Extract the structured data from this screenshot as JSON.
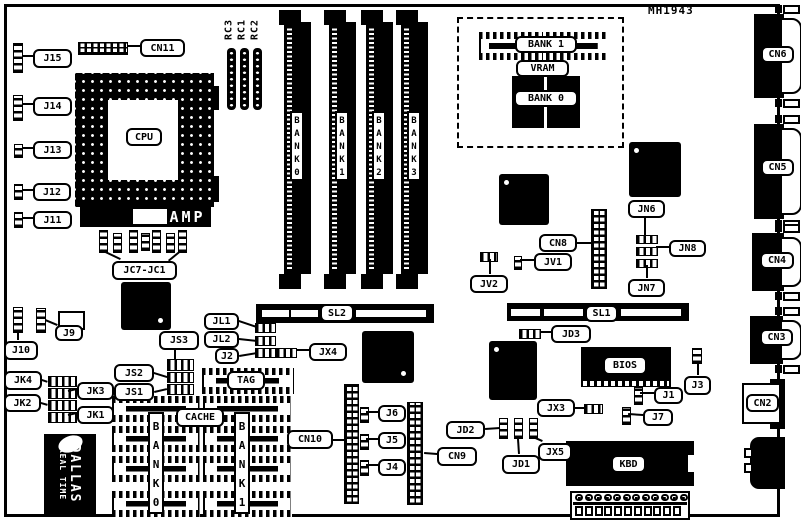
{
  "diagram": {
    "part_number": "MH1943",
    "colors": {
      "ink": "#000000",
      "paper": "#ffffff"
    },
    "labels": {
      "mh": "MH1943",
      "j15": "J15",
      "cn11": "CN11",
      "j14": "J14",
      "j13": "J13",
      "j12": "J12",
      "j11": "J11",
      "cpu": "CPU",
      "amp": "AMP",
      "jc7jc1": "JC7-JC1",
      "rc3": "RC3",
      "rc1": "RC1",
      "rc2": "RC2",
      "bank0_simm": "BANK0",
      "bank1_simm": "BANK1",
      "bank2_simm": "BANK2",
      "bank3_simm": "BANK3",
      "vbank1": "BANK 1",
      "vram": "VRAM",
      "vbank0": "BANK 0",
      "cn6": "CN6",
      "cn5": "CN5",
      "cn4": "CN4",
      "cn3": "CN3",
      "cn2": "CN2",
      "jn6": "JN6",
      "jn8": "JN8",
      "jn7": "JN7",
      "cn8": "CN8",
      "jv1": "JV1",
      "jv2": "JV2",
      "sl2": "SL2",
      "sl1": "SL1",
      "jl1": "JL1",
      "jl2": "JL2",
      "j2": "J2",
      "jx4": "JX4",
      "j10": "J10",
      "j9": "J9",
      "js3": "JS3",
      "js2": "JS2",
      "js1": "JS1",
      "jk4": "JK4",
      "jk3": "JK3",
      "jk2": "JK2",
      "jk1": "JK1",
      "tag": "TAG",
      "cache": "CACHE",
      "bank0_cache": "BANK0",
      "bank1_cache": "BANK1",
      "dallas_brand": "DALLAS",
      "dallas_line2": "REAL TIME",
      "jd3": "JD3",
      "bios": "BIOS",
      "j3": "J3",
      "j1": "J1",
      "j7": "J7",
      "jx3": "JX3",
      "jd2": "JD2",
      "jd1": "JD1",
      "jx5": "JX5",
      "cn10": "CN10",
      "cn9": "CN9",
      "j6": "J6",
      "j5": "J5",
      "j4": "J4",
      "kbd": "KBD"
    }
  }
}
